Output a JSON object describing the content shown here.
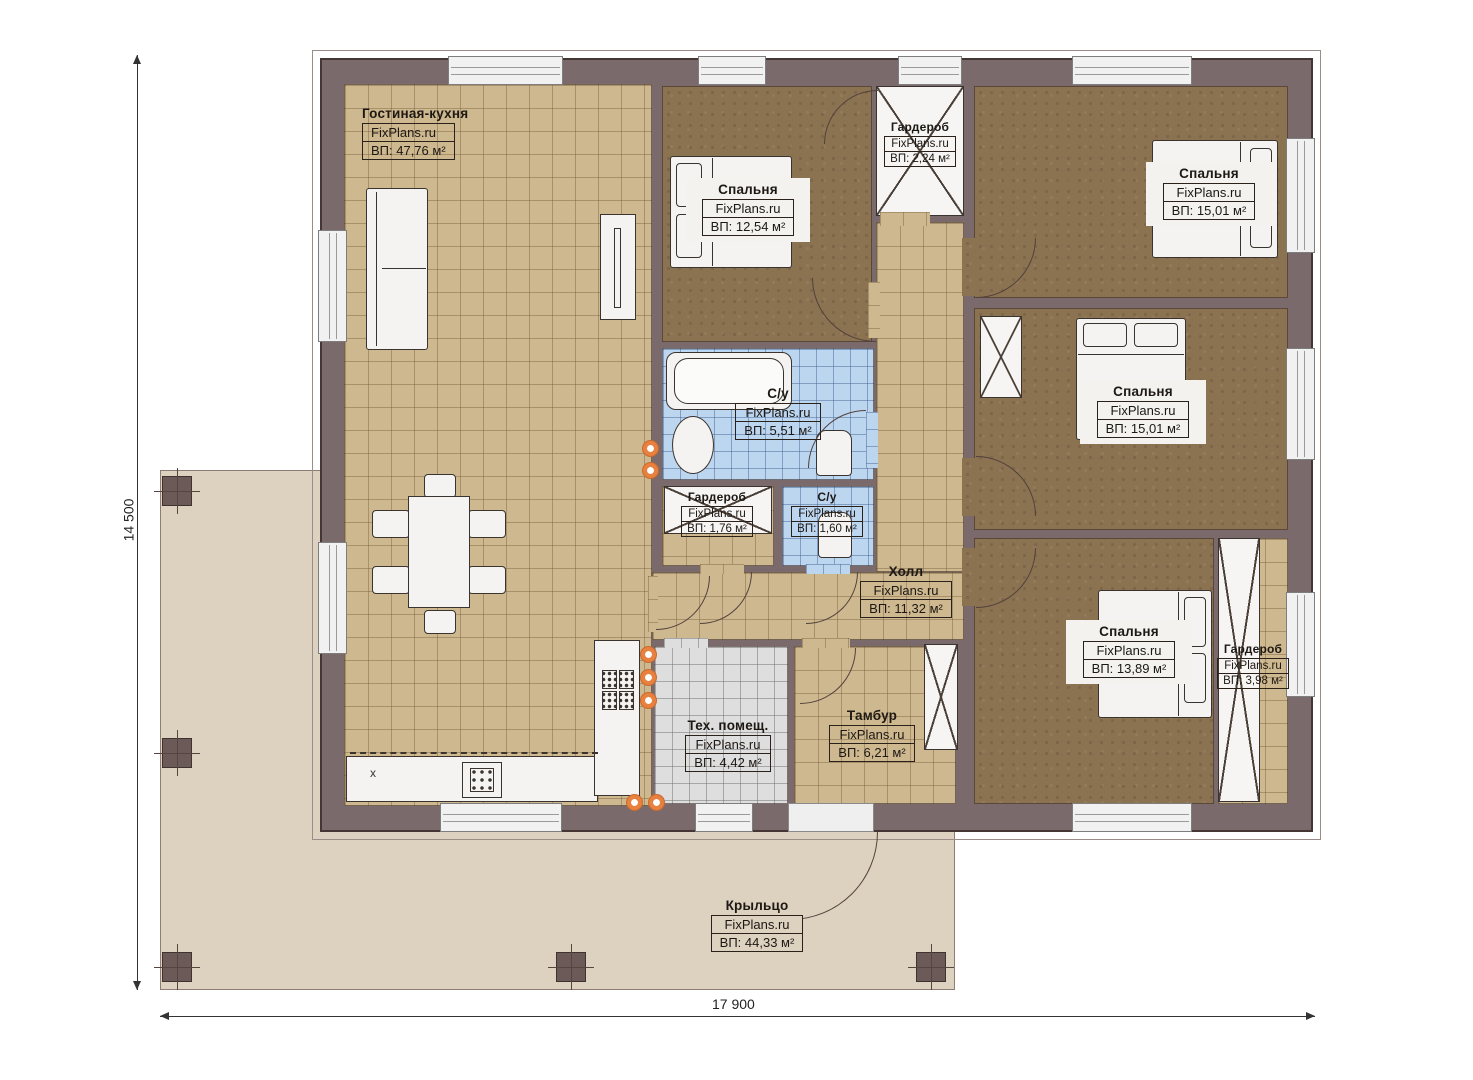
{
  "brand": "FixPlans.ru",
  "dimensions": {
    "height_label": "14 500",
    "width_label": "17 900"
  },
  "misc": {
    "kitchen_mark": "x"
  },
  "colors": {
    "wall": "#7b6a6b",
    "floor_tan": "#cdb88f",
    "carpet": "#8b7251",
    "tile_blue": "#bdd6ef",
    "tile_gray": "#dedede",
    "porch": "#ddd1bf",
    "accent_dot": "#e8813f"
  },
  "rooms": {
    "living": {
      "name": "Гостиная-кухня",
      "area": "ВП: 47,76 м²"
    },
    "bedroom_top": {
      "name": "Спальня",
      "area": "ВП: 12,54 м²"
    },
    "wardrobe_top": {
      "name": "Гардероб",
      "area": "ВП: 2,24 м²"
    },
    "bedroom_ne": {
      "name": "Спальня",
      "area": "ВП: 15,01 м²"
    },
    "bedroom_e": {
      "name": "Спальня",
      "area": "ВП: 15,01 м²"
    },
    "bathroom": {
      "name": "С/у",
      "area": "ВП: 5,51 м²"
    },
    "wardrobe_hall": {
      "name": "Гардероб",
      "area": "ВП: 1,76 м²"
    },
    "wc_hall": {
      "name": "С/у",
      "area": "ВП: 1,60 м²"
    },
    "hall": {
      "name": "Холл",
      "area": "ВП: 11,32 м²"
    },
    "bedroom_se": {
      "name": "Спальня",
      "area": "ВП: 13,89 м²"
    },
    "wardrobe_se": {
      "name": "Гардероб",
      "area": "ВП: 3,98 м²"
    },
    "tech": {
      "name": "Тех. помещ.",
      "area": "ВП: 4,42 м²"
    },
    "tambour": {
      "name": "Тамбур",
      "area": "ВП: 6,21 м²"
    },
    "porch": {
      "name": "Крыльцо",
      "area": "ВП: 44,33 м²"
    }
  }
}
